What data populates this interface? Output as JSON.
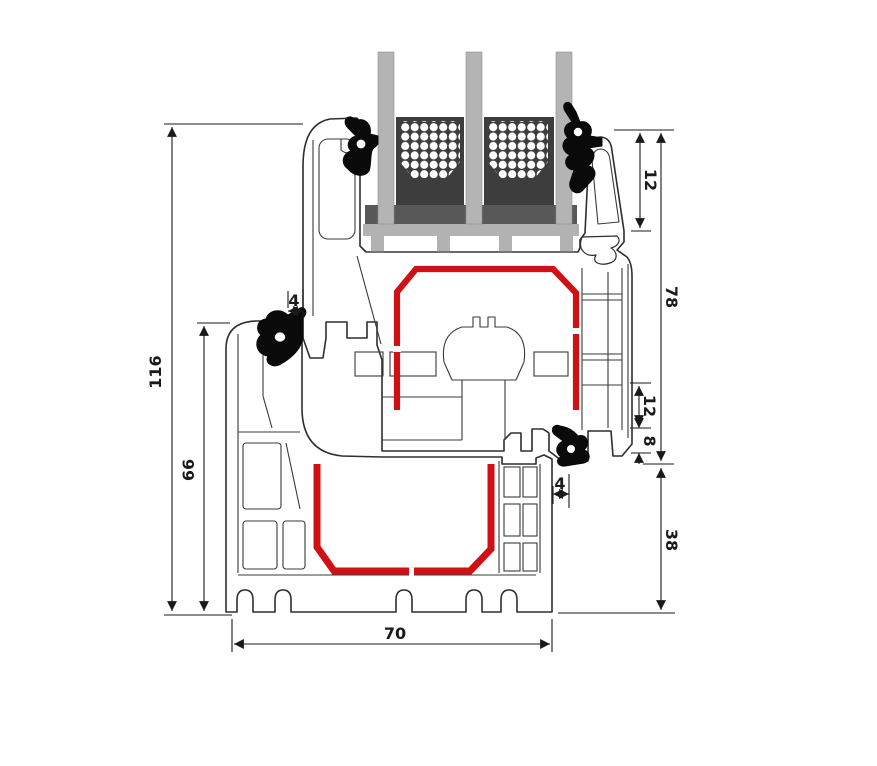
{
  "diagram": {
    "kind": "window-profile-cross-section",
    "units": "mm",
    "labels": {
      "total_height": "116",
      "frame_height": "66",
      "frame_width": "70",
      "glazing_inset": "12",
      "sash_height": "78",
      "hardware_step": "12",
      "overlap": "8",
      "gasket_gap_top": "4",
      "gasket_gap_right": "4",
      "frame_face_height": "38"
    },
    "colors": {
      "reinforcement_steel": "#cf1116",
      "profile_outline": "#2e2e2e",
      "gasket": "#0a0a0a",
      "glass": "#b4b4b4",
      "spacer_bar": "#3d3d3d",
      "setting_block": "#585858"
    }
  }
}
